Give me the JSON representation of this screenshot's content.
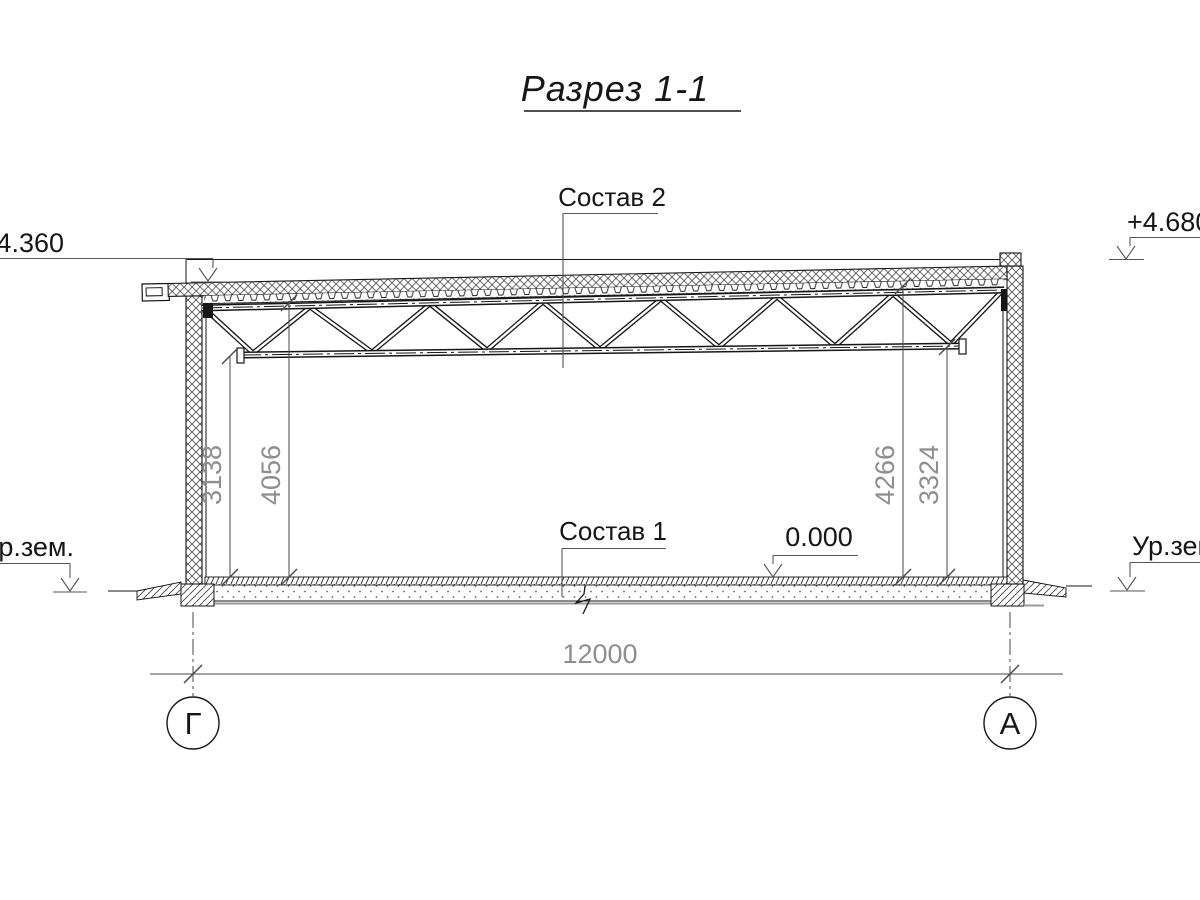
{
  "title": "Разрез 1-1",
  "callouts": {
    "roof": "Состав 2",
    "floor": "Состав 1"
  },
  "elevations": {
    "left": "+4.360",
    "right": "+4.680",
    "zero": "0.000"
  },
  "ground": {
    "left": "Ур.зем.",
    "right": "Ур.зем."
  },
  "dims": {
    "v_left_inner": "3138",
    "v_left_outer": "4056",
    "v_right_inner": "4266",
    "v_right_outer": "3324",
    "span": "12000"
  },
  "axes": {
    "left": "Г",
    "right": "А"
  },
  "colors": {
    "line": "#161616",
    "dim_line": "#4a4a4a",
    "dim_text": "#8e8e8e",
    "leader": "#555555",
    "slab_bottom": "#9a9a9a",
    "background": "#ffffff"
  }
}
